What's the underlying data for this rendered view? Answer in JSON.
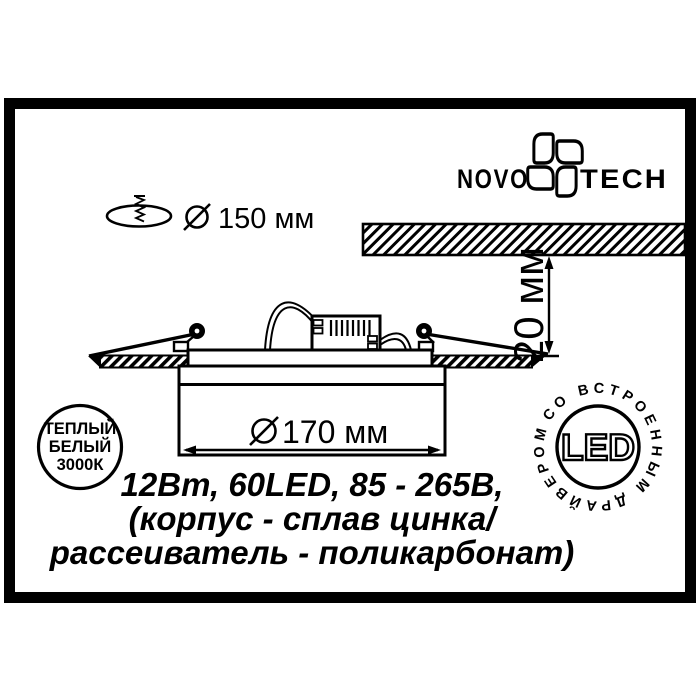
{
  "brand": {
    "name_left": "NOVO",
    "name_right": "TECH"
  },
  "cutout_dimension": {
    "symbol": "⌀",
    "text": "150 мм"
  },
  "recess_depth_dimension": {
    "text": "20 мм"
  },
  "body_diameter_dimension": {
    "symbol": "⌀",
    "text": "170 мм"
  },
  "specs": {
    "line1": "12Вт, 60LED, 85 - 265В,",
    "line2": "(корпус - сплав цинка/",
    "line3": "рассеиватель - поликарбонат)"
  },
  "warm_white_badge": {
    "line1": "ТЕПЛЫЙ",
    "line2": "БЕЛЫЙ",
    "line3": "3000К"
  },
  "led_badge": {
    "ring_text": "СО ВСТРОЕННЫМ ДРАЙВЕРОМ",
    "center_text": "LED"
  },
  "colors": {
    "ink": "#000000",
    "paper": "#ffffff"
  }
}
